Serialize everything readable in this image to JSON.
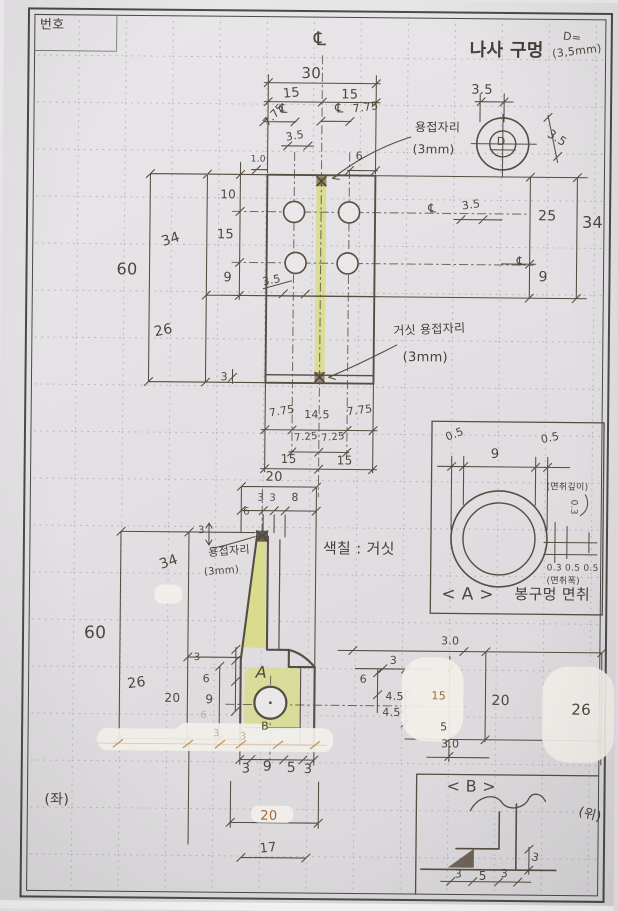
{
  "palette": {
    "ink": "#564c40",
    "sepia": "#a06a32",
    "highlight": "#d8dc85",
    "paper": "#e4e2e4",
    "border": "#4a4a4a"
  },
  "sheet": {
    "no": "번호",
    "left_note": "(좌)",
    "top_note": "(위)"
  },
  "fv": {
    "cl": "℄",
    "w30": "30",
    "w15l": "15",
    "w15r": "15",
    "cl_l": "℄",
    "o775l": "7.75",
    "cl_r": "℄",
    "o775r": "7.75",
    "d35": "3.5",
    "d6": "6",
    "d10s": "1.0",
    "d10": "10",
    "d15": "15",
    "d9": "9",
    "d34": "34",
    "d60": "60",
    "d26": "26",
    "d3": "3",
    "hole35": "3.5",
    "cl_row1": "℄",
    "r35": "3.5",
    "cl_row2": "℄",
    "r25": "25",
    "r34": "34",
    "r9": "9",
    "c775l": "7.75",
    "c145": "14.5",
    "c775r": "7.75",
    "c725l": "7.25",
    "c725r": "7.25",
    "c15l": "15",
    "c15r": "15",
    "c20": "20"
  },
  "sd": {
    "title": "나사 구멍",
    "deq": "D=",
    "dval": "(3,5mm)",
    "top35": "3.5",
    "right35": "3.5",
    "letter": "D",
    "weld": "용접자리",
    "weldmm": "(3mm)"
  },
  "gn": {
    "label": "거싯 용접자리",
    "mm": "(3mm)"
  },
  "sv": {
    "t3a": "3",
    "t3b": "3",
    "t8": "8",
    "t6": "6",
    "w3": "3",
    "weld": "용접자리",
    "weldmm": "(3mm)",
    "note": "색칠 : 거싯",
    "d34": "34",
    "d60": "60",
    "d26": "26",
    "d20": "20",
    "d3": "3",
    "d6": "6",
    "d9": "9",
    "a": "A",
    "b": "B",
    "b3a": "3",
    "b9": "9",
    "b5": "5",
    "b3b": "3",
    "b20": "20",
    "b17": "17",
    "f3a": "3",
    "f3b": "3",
    "f6": "6",
    "r30t": "3.0",
    "r3": "3",
    "r6": "6",
    "r45a": "4.5",
    "r45b": "4.5",
    "r15": "15",
    "r20": "20",
    "r26": "26",
    "r5": "5",
    "r30b": "3.0"
  },
  "da": {
    "l05": "0.5",
    "m9": "9",
    "r05": "0.5",
    "depth": "(면취깊이)",
    "dv": "0.3",
    "ws": "0.3 0.5 0.5",
    "wn": "(면취폭)",
    "cap": "< A >",
    "capt": "봉구멍 면취"
  },
  "db": {
    "cap": "< B >",
    "d1": "3",
    "d2": "5",
    "d3": "3",
    "dr": "3"
  }
}
